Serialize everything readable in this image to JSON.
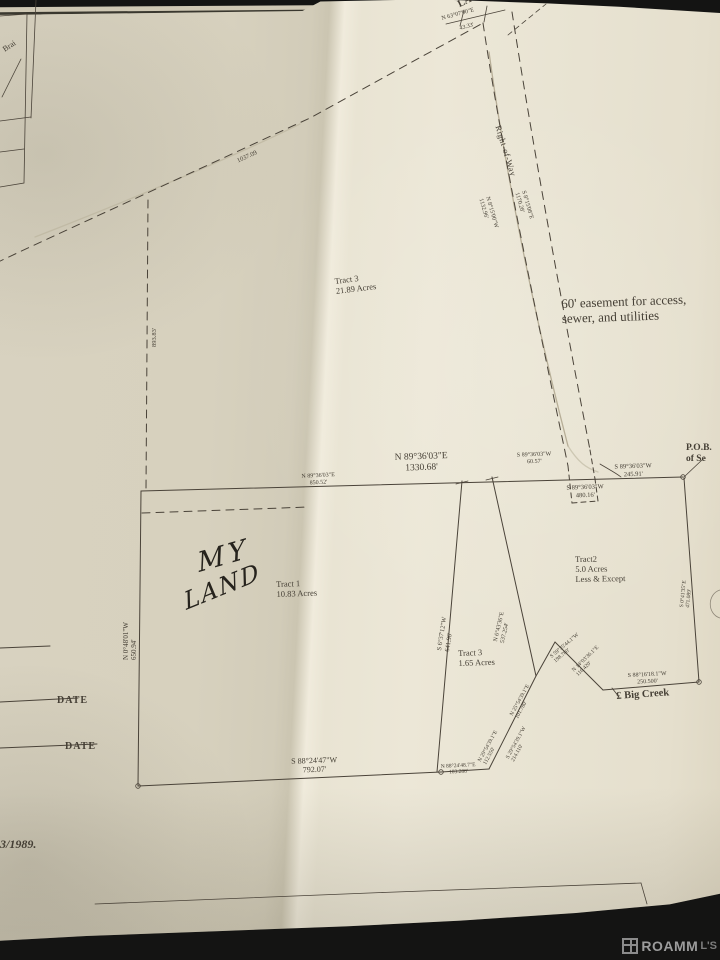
{
  "document_title": "Survey plat photograph",
  "colors": {
    "background": "#141413",
    "paper": "#e9e4d3",
    "paper_shaded": "#d7d1be",
    "ink": "#4a4339",
    "pencil": "#b7ae97",
    "handwriting": "#26231d",
    "watermark_text": "#9c9c9c"
  },
  "watermark": {
    "brand": "ROAMM",
    "suffix": "L'S"
  },
  "plat": {
    "labels": [
      {
        "name": "label-la10",
        "text": "LA 10",
        "x": 456,
        "y": 0,
        "rot": -26,
        "size": 10,
        "w": 700
      },
      {
        "name": "label-la10-bearing",
        "text": "N 63°07'00\"E",
        "x": 441,
        "y": 16,
        "rot": -15,
        "size": 6
      },
      {
        "name": "label-la10-distance",
        "text": "43.33'",
        "x": 459,
        "y": 26,
        "rot": -15,
        "size": 6
      },
      {
        "name": "label-right-of-way",
        "text": "Right-of-Way",
        "x": 503,
        "y": 124,
        "rot": 73,
        "size": 8.5,
        "ls": 0.5
      },
      {
        "name": "label-row-bearing-west",
        "text": "N 8°15'00\"W\n1132.96'",
        "x": 490,
        "y": 196,
        "rot": 74,
        "size": 6
      },
      {
        "name": "label-row-bearing-east",
        "text": "S 8°15'08\"E\n1170.28'",
        "x": 526,
        "y": 190,
        "rot": 74,
        "size": 6
      },
      {
        "name": "label-distance-1037",
        "text": "1037.09",
        "x": 236,
        "y": 158,
        "rot": -24,
        "size": 6.5
      },
      {
        "name": "label-distance-893",
        "text": "893.83'",
        "x": 151,
        "y": 347,
        "rot": -90,
        "size": 6.5
      },
      {
        "name": "label-tract3-large",
        "text": "Tract 3\n21.89 Acres",
        "x": 334,
        "y": 276,
        "rot": -7,
        "size": 8.5
      },
      {
        "name": "label-easement-note",
        "text": "60' easement for access,\nsewer, and utilities",
        "x": 561,
        "y": 296,
        "rot": -2,
        "size": 13
      },
      {
        "name": "label-mid-bearing-main",
        "text": "N 89°36'03\"E\n1330.68'",
        "x": 421,
        "y": 452,
        "rot": -2,
        "size": 9.5,
        "align": "center"
      },
      {
        "name": "label-mid-bearing-6057",
        "text": "S 89°36'03\"W\n60.57'",
        "x": 534,
        "y": 452,
        "rot": -2,
        "size": 6,
        "align": "center"
      },
      {
        "name": "label-mid-bearing-24591",
        "text": "S 89°36'03\"W\n245.91'",
        "x": 633,
        "y": 463,
        "rot": -2,
        "size": 6.5,
        "align": "center"
      },
      {
        "name": "label-mid-bearing-48016",
        "text": "S 89°36'03\"W\n480.16'",
        "x": 585,
        "y": 484,
        "rot": -2,
        "size": 6.5,
        "align": "center"
      },
      {
        "name": "label-mid-bearing-85052",
        "text": "N 89°36'03\"E\n850.52'",
        "x": 318,
        "y": 473,
        "rot": -3,
        "size": 6,
        "align": "center"
      },
      {
        "name": "label-pob",
        "text": "P.O.B.\nof Se",
        "x": 686,
        "y": 443,
        "size": 9.5,
        "w": 700
      },
      {
        "name": "label-west-bearing-tract1",
        "text": "N 0°48'01\"W\n650.94'",
        "x": 122,
        "y": 660,
        "rot": -90,
        "size": 7
      },
      {
        "name": "label-handwriting-my",
        "text": "MY",
        "x": 196,
        "y": 550,
        "rot": -16,
        "size": 27,
        "cls": "hand",
        "ls": 4,
        "skew": -8
      },
      {
        "name": "label-handwriting-land",
        "text": "LAND",
        "x": 182,
        "y": 590,
        "rot": -22,
        "size": 24,
        "cls": "hand",
        "ls": 2,
        "skew": -10
      },
      {
        "name": "label-tract1",
        "text": "Tract 1\n10.83 Acres",
        "x": 276,
        "y": 579,
        "rot": -2,
        "size": 8.5
      },
      {
        "name": "label-tract2",
        "text": "Tract2\n5.0 Acres\nLess & Except",
        "x": 575,
        "y": 554,
        "rot": -1,
        "size": 8.5
      },
      {
        "name": "label-east-bearing-tract1",
        "text": "S 6°37'12\"W\n641.96'",
        "x": 436,
        "y": 650,
        "rot": -81,
        "size": 6.5
      },
      {
        "name": "label-strip-east-bearing",
        "text": "N 6°43'36\"E\n537.254'",
        "x": 493,
        "y": 641,
        "rot": -77,
        "size": 6
      },
      {
        "name": "label-tract3-small",
        "text": "Tract 3\n1.65 Acres",
        "x": 458,
        "y": 648,
        "rot": -2,
        "size": 8.5
      },
      {
        "name": "label-east-bearing-tract2",
        "text": "S 0°41'35\"E\n471.089'",
        "x": 679,
        "y": 607,
        "rot": -84,
        "size": 5.5
      },
      {
        "name": "label-creek-bearing-1",
        "text": "S 59°35'44.1\"W\n198.780'",
        "x": 549,
        "y": 655,
        "rot": -40,
        "size": 5.5
      },
      {
        "name": "label-creek-bearing-2",
        "text": "N 14°03'36.1\"E\n116.420'",
        "x": 571,
        "y": 669,
        "rot": -44,
        "size": 5.5
      },
      {
        "name": "label-creek-bearing-3",
        "text": "S 88°16'18.1\"W\n250.500'",
        "x": 647,
        "y": 672,
        "rot": -3,
        "size": 6,
        "align": "center"
      },
      {
        "name": "label-big-creek",
        "text": "£ Big Creek",
        "x": 616,
        "y": 691,
        "rot": -4,
        "size": 10.5,
        "w": 600
      },
      {
        "name": "label-creek-bearing-4",
        "text": "N 25°54'39.1\"E\n101.780'",
        "x": 509,
        "y": 714,
        "rot": -61,
        "size": 5.5
      },
      {
        "name": "label-creek-bearing-5",
        "text": "S 29°54'39.1\"W\n214.110'",
        "x": 505,
        "y": 757,
        "rot": -61,
        "size": 5.5
      },
      {
        "name": "label-creek-bearing-6",
        "text": "N 29°54'39.1\"E\n112.550'",
        "x": 477,
        "y": 760,
        "rot": -61,
        "size": 5.5
      },
      {
        "name": "label-south-bearing-tract1",
        "text": "S 88°24'47\"W\n792.07'",
        "x": 314,
        "y": 756,
        "rot": -2,
        "size": 8,
        "align": "center"
      },
      {
        "name": "label-south-bearing-2",
        "text": "N 88°24'48.7\"E\n103.288'",
        "x": 458,
        "y": 763,
        "rot": -3,
        "size": 5.5,
        "align": "center"
      },
      {
        "name": "label-date-1",
        "text": "DATE",
        "x": 57,
        "y": 695,
        "size": 10,
        "w": 700,
        "ls": 1
      },
      {
        "name": "label-date-2",
        "text": "DATE",
        "x": 65,
        "y": 741,
        "size": 10,
        "w": 700,
        "ls": 1
      },
      {
        "name": "label-plat-date",
        "text": "3/1989.",
        "x": 0,
        "y": 837,
        "size": 12,
        "w": 700,
        "cls": "ital"
      },
      {
        "name": "label-vicinity",
        "text": "Brai",
        "x": 1,
        "y": 46,
        "rot": -33,
        "size": 8
      }
    ]
  }
}
